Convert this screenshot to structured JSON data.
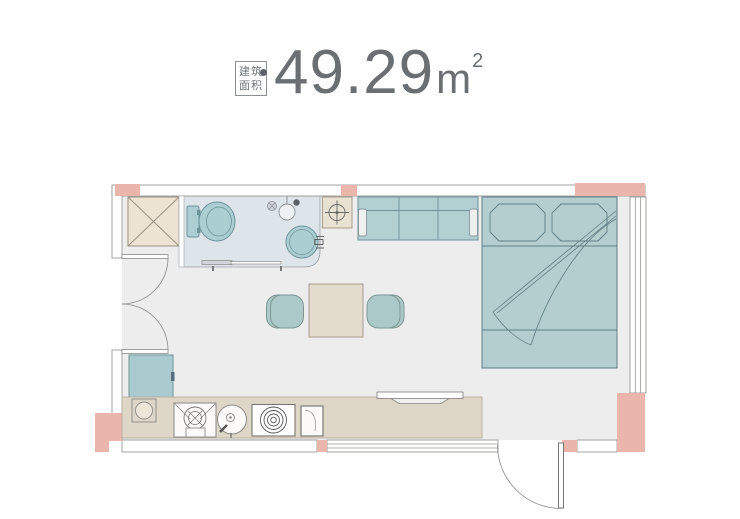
{
  "header": {
    "area_badge": {
      "line1": "建筑",
      "line2": "面积"
    },
    "area_value": "49.29",
    "area_unit": "m",
    "area_superscript": "2"
  },
  "palette": {
    "wall_pink": "#eab5ab",
    "floor_gray": "#ededee",
    "bathroom_floor": "#dde4ea",
    "furniture_teal": "#b2cfd2",
    "fixture_teal": "#abced2",
    "furniture_beige": "#ece3d3",
    "counter_beige": "#ded6c6",
    "table_beige": "#e3dccc",
    "wall_outline": "#9a9a98",
    "fixture_outline": "#6d949b",
    "text_gray": "#6b6f72"
  },
  "floor_plan": {
    "elements": [
      "shaft",
      "bathroom",
      "toilet",
      "shower-point",
      "floor-drain",
      "washbasin",
      "exhaust-unit",
      "sofa",
      "double-bed",
      "pillows",
      "dining-table",
      "stools",
      "refrigerator",
      "kitchen-counter",
      "sink",
      "frying-pan",
      "cooktop",
      "cutting-board",
      "tv",
      "entry-door",
      "interior-double-door",
      "bottom-window",
      "right-window"
    ]
  }
}
